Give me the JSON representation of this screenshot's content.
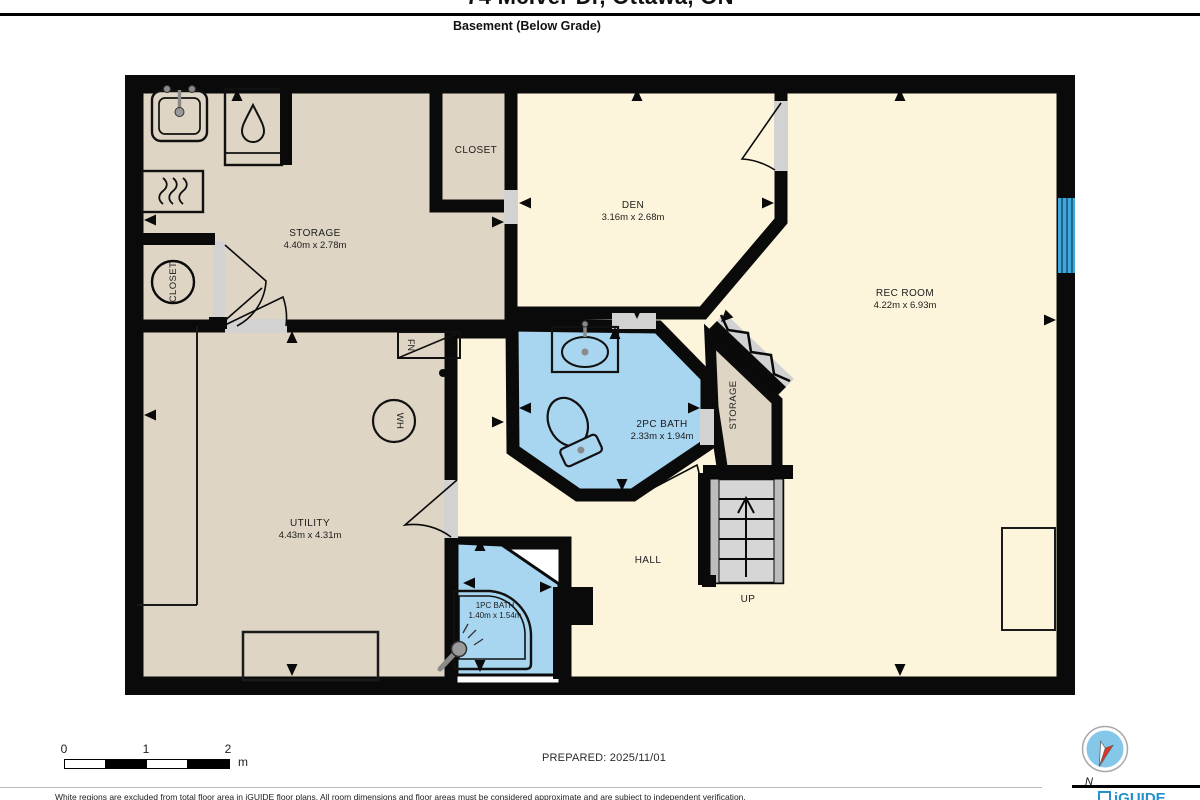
{
  "header": {
    "address": "74 McIver Dr, Ottawa, ON",
    "floor_label": "Basement (Below Grade)"
  },
  "rooms": {
    "storage": {
      "name": "STORAGE",
      "dims": "4.40m x 2.78m"
    },
    "closet_top": {
      "name": "CLOSET"
    },
    "closet_small": {
      "name": "CLOSET"
    },
    "den": {
      "name": "DEN",
      "dims": "3.16m x 2.68m"
    },
    "rec_room": {
      "name": "REC ROOM",
      "dims": "4.22m x 6.93m"
    },
    "bath_2pc": {
      "name": "2PC BATH",
      "dims": "2.33m x 1.94m"
    },
    "storage_under": {
      "name": "STORAGE"
    },
    "utility": {
      "name": "UTILITY",
      "dims": "4.43m x 4.31m"
    },
    "hall": {
      "name": "HALL"
    },
    "bath_1pc": {
      "name": "1PC BATH",
      "dims": "1.40m x 1.54m"
    }
  },
  "markers": {
    "up": "UP",
    "water_heater": "WH",
    "furnace": "FN",
    "compass_north": "N"
  },
  "scale": {
    "t0": "0",
    "t1": "1",
    "t2": "2",
    "unit": "m"
  },
  "footer": {
    "prepared": "PREPARED: 2025/11/01",
    "disclaimer": "White regions are excluded from total floor area in iGUIDE floor plans. All room dimensions and floor areas must be considered approximate and are subject to independent verification.",
    "brand": "iGUIDE"
  },
  "colors": {
    "wall": "#0a0a0a",
    "room_beige": "#DED5C4",
    "room_cream": "#FCF5DC",
    "bath_blue": "#A8D5F0",
    "window_blue": "#3FA7DC",
    "stair_gray": "#D6D6D6",
    "opening_gray": "#D2D2D2",
    "brand_blue": "#2591CC",
    "compass_red": "#E03224"
  }
}
